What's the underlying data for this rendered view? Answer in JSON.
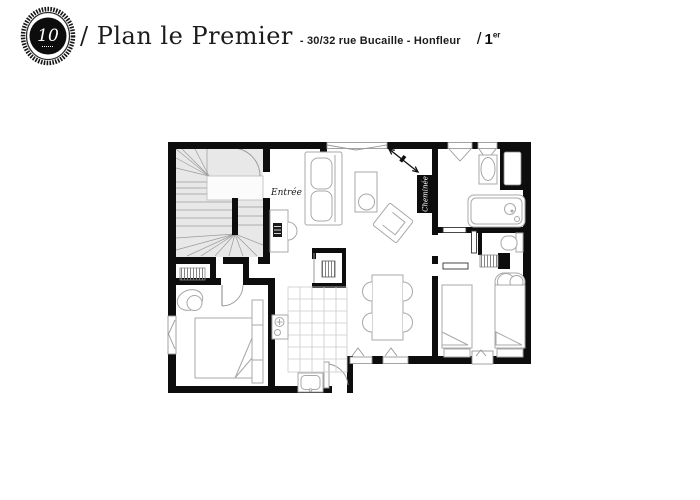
{
  "header": {
    "logo_monogram": "10",
    "title": "/ Plan le Premier",
    "subtitle": "- 30/32 rue Bucaille - Honfleur",
    "floor": {
      "slash": "/",
      "number": "1",
      "suffix": "er"
    }
  },
  "plan": {
    "labels": {
      "entree": "Entrée",
      "cheminee": "Cheminée"
    },
    "colors": {
      "wall": "#0d0d0d",
      "stair_fill": "#e8e8e8",
      "furniture_stroke": "#a8a8a8",
      "tile_stroke": "#cccccc",
      "fireplace_bg": "#0d0d0d",
      "fireplace_text": "#ffffff",
      "background": "#ffffff"
    }
  }
}
